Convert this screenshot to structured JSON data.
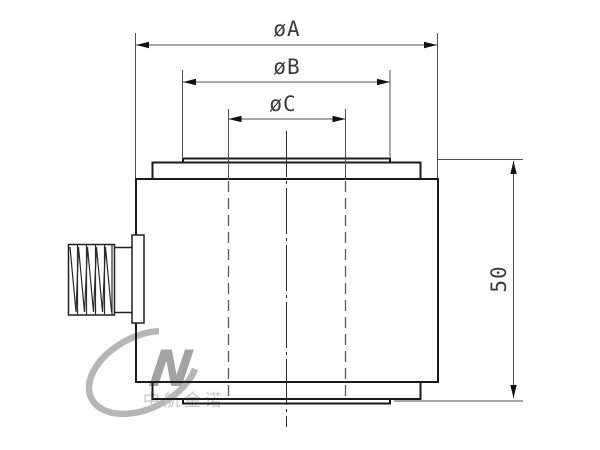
{
  "dimensions": {
    "a": {
      "label": "øA"
    },
    "b": {
      "label": "øB"
    },
    "c": {
      "label": "øC"
    },
    "height": {
      "label": "50"
    }
  },
  "watermark": {
    "logo_letter": "N",
    "company_text": "中航金诺"
  },
  "colors": {
    "outline": "#1b1b1b",
    "dimension_lines": "#4f4f4f",
    "dimension_text": "#3c3c3c",
    "watermark_gray": "#b6b6b6",
    "watermark_text": "#c6c6c6",
    "background": "#ffffff"
  }
}
